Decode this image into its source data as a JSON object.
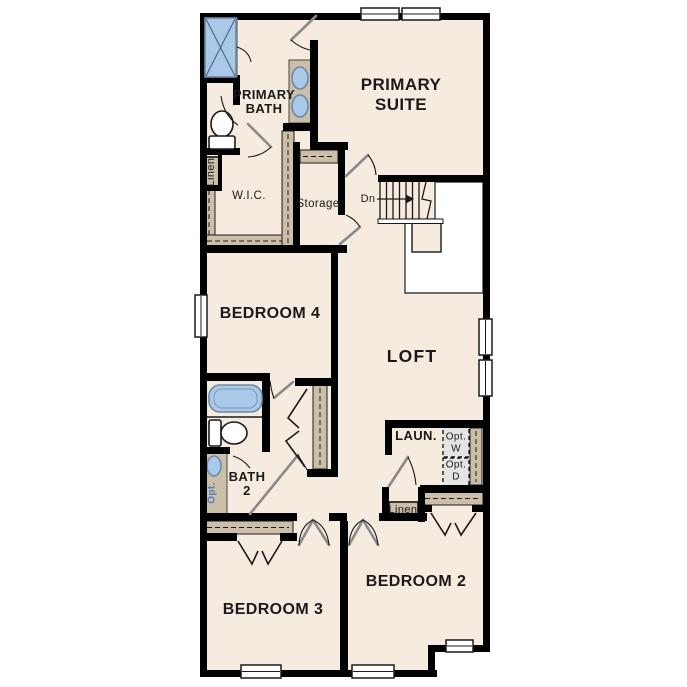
{
  "colors": {
    "background": "#ffffff",
    "floor": "#f5ecdf",
    "wall": "#000000",
    "shelf": "#cbbfa8",
    "fixture_blue": "#a9c9e9",
    "fixture_blue_border": "#6d89a4",
    "door_gray": "#8a8a8a",
    "optional_fill": "#e4e4e4",
    "label_text": "#1a1a1a",
    "accent_blue_text": "#4d7fc4"
  },
  "rooms": {
    "primary_suite": {
      "line1": "PRIMARY",
      "line2": "SUITE"
    },
    "primary_bath": {
      "line1": "PRIMARY",
      "line2": "BATH"
    },
    "wic": {
      "label": "W.I.C."
    },
    "storage": {
      "label": "Storage"
    },
    "stairs": {
      "down_label": "Dn"
    },
    "bedroom4": {
      "label": "BEDROOM 4"
    },
    "loft": {
      "label": "LOFT"
    },
    "bath2": {
      "line1": "BATH",
      "line2": "2"
    },
    "laundry": {
      "label": "LAUN."
    },
    "optional_washer": {
      "line1": "Opt.",
      "line2": "W"
    },
    "optional_dryer": {
      "line1": "Opt.",
      "line2": "D"
    },
    "optional_sink": {
      "label": "Opt."
    },
    "linen_primary": {
      "label": "Linen"
    },
    "linen_hall": {
      "label": "Linen"
    },
    "bedroom3": {
      "label": "BEDROOM 3"
    },
    "bedroom2": {
      "label": "BEDROOM 2"
    }
  }
}
